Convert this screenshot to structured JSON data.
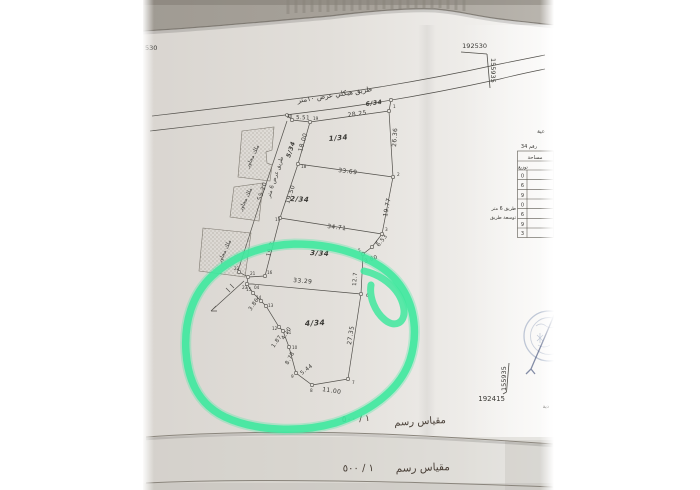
{
  "photo": {
    "coord_markers": {
      "top": {
        "easting": "192530",
        "northing": "155935"
      },
      "bottom": {
        "easting": "192415",
        "northing": "155935"
      },
      "left_partial": "530"
    },
    "roads": {
      "north": {
        "name": "طريق هيكلي عرض ١٠متر",
        "number": "6/34",
        "frontage_length": "28.25"
      },
      "west": {
        "name": "طريق عرض 6 متر",
        "number": "5/34",
        "length": "55.20"
      }
    },
    "parcels": {
      "p1": {
        "label": "1/34",
        "north_seg": "5.51",
        "west": "18.00",
        "east": "26.36",
        "south": "33.69"
      },
      "p2": {
        "label": "2/34",
        "west": "19.50",
        "east": "19.77",
        "south": "34.71"
      },
      "p3": {
        "label": "3/34",
        "west": "19.3",
        "east_seg1": "6.53",
        "east_seg2": "3.80",
        "east_seg3": "12.7",
        "south": "33.29"
      },
      "p4": {
        "label": "4/34",
        "east": "27.35",
        "south": "11.00",
        "sw1": "5.44",
        "sw2": "8.78",
        "sw3": "1.87",
        "sw4": "4.10",
        "sw5": "3.86"
      }
    },
    "neighbor_label": "ملك مجاور",
    "vertex_numbers": {
      "n1": "1",
      "n2": "2",
      "n3": "3",
      "n4": "4",
      "n5": "5",
      "n6": "6",
      "n7": "7",
      "n8": "8",
      "n9": "9",
      "n10": "10",
      "n11": "11",
      "n12": "12",
      "n13": "13",
      "n14": "14",
      "n15": "15",
      "n16": "16",
      "n17": "17",
      "n18": "18",
      "n19": "19",
      "n20": "20",
      "n21": "21",
      "n22": "22",
      "n23": "23",
      "n04": "04"
    },
    "table": {
      "title_fragment": "عية",
      "ref_fragment": "رقم 34",
      "header_area": "مساحة",
      "header_dist": "توزيع",
      "rows": [
        "0",
        "6",
        "9",
        "0",
        "6",
        "9",
        "3"
      ],
      "side_label_1": "طريق 6 متر",
      "side_label_2": "توسعة طريق"
    },
    "scale": {
      "caption": "مقياس رسم",
      "ratio": "١ / ٥٠٠"
    },
    "bottom_right_fragment": "دية",
    "colors": {
      "highlighter": "#3fe89e",
      "stamp": "#8495b5"
    }
  }
}
